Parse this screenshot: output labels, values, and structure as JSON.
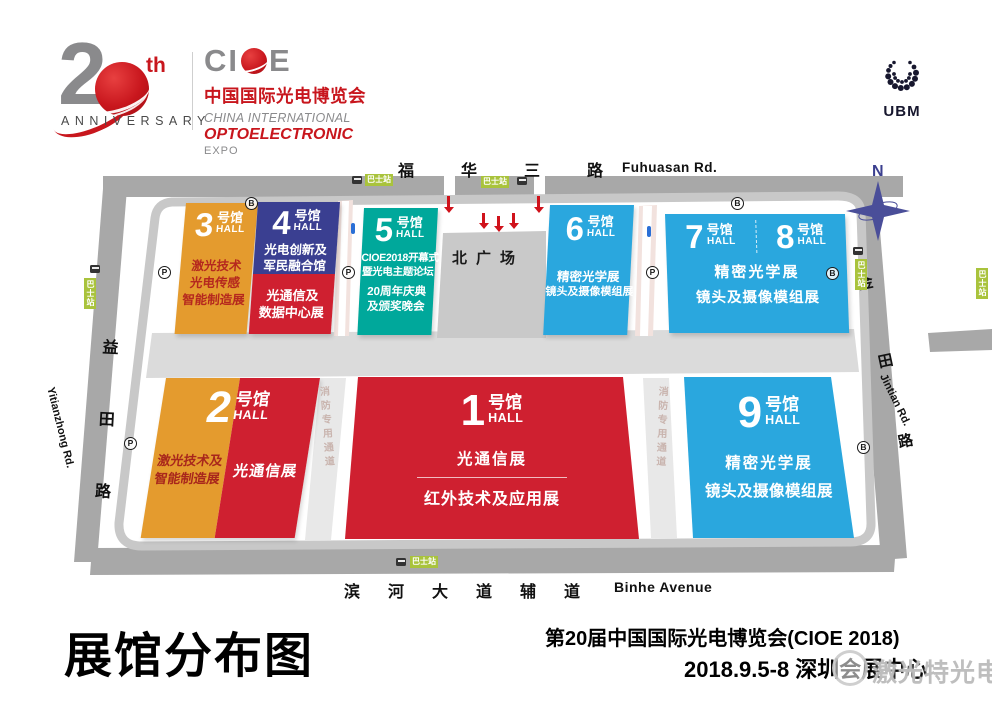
{
  "colors": {
    "brand_red": "#C8161D",
    "logo_gray": "#8A8A8C",
    "hall_orange": "#E49B2E",
    "hall_red": "#CF2030",
    "hall_deep_blue": "#3A3F91",
    "hall_teal": "#00A89B",
    "hall_sky_blue": "#2AA7DE",
    "hall3_body_text": "#B5281E",
    "road_gray": "#A8A8A8",
    "band_gray": "#DBDBDB",
    "plaza_gray": "#C9C9C9",
    "bus_green": "#A9C33C",
    "compass_navy": "#4A4E99",
    "arrow_red": "#D0121B"
  },
  "header": {
    "anniversary": {
      "big_digit": "2",
      "th": "th",
      "label": "ANNIVERSARY"
    },
    "cioe": {
      "wordmark_left": "CI",
      "wordmark_right": "E",
      "cn": "中国国际光电博览会",
      "en_line1": "CHINA INTERNATIONAL",
      "en_line2": "OPTOELECTRONIC",
      "en_line3": "EXPO"
    },
    "ubm": {
      "label": "UBM"
    }
  },
  "compass": {
    "label": "N"
  },
  "roads": {
    "top": {
      "cn": "福华三路",
      "en": "Fuhuasan Rd."
    },
    "bottom": {
      "cn": "滨河大道辅道",
      "en": "Binhe Avenue"
    },
    "left": {
      "cn": "益田路",
      "en": "Yitianzhong Rd."
    },
    "right": {
      "cn_chars": [
        "金",
        "田",
        "路"
      ],
      "en": "Jintian Rd."
    }
  },
  "map": {
    "plaza_label": "北广场",
    "fire_lane_label": "消防专用通道",
    "bus_stop_label": "巴士站",
    "parking_icon": "P",
    "bus_icon": "B",
    "hall_suffix_cn": "号馆",
    "hall_suffix_en": "HALL",
    "halls": {
      "h1": {
        "num": "1",
        "line1": "光通信展",
        "line2": "红外技术及应用展"
      },
      "h2": {
        "num": "2",
        "left_line1": "激光技术及",
        "left_line2": "智能制造展",
        "right_line1": "光通信展"
      },
      "h3": {
        "num": "3",
        "line1": "激光技术",
        "line2": "光电传感",
        "line3": "智能制造展"
      },
      "h4": {
        "num": "4",
        "top_line1": "光电创新及",
        "top_line2": "军民融合馆",
        "bot_line1": "光通信及",
        "bot_line2": "数据中心展"
      },
      "h5": {
        "num": "5",
        "line1": "CIOE2018开幕式",
        "line2": "暨光电主题论坛",
        "line3": "20周年庆典",
        "line4": "及颁奖晚会"
      },
      "h6": {
        "num": "6",
        "line1": "精密光学展",
        "line2": "镜头及摄像模组展"
      },
      "h7": {
        "num": "7"
      },
      "h8": {
        "num": "8",
        "line1": "精密光学展",
        "line2": "镜头及摄像模组展"
      },
      "h9": {
        "num": "9",
        "line1": "精密光学展",
        "line2": "镜头及摄像模组展"
      }
    }
  },
  "footer": {
    "title": "展馆分布图",
    "event_name": "第20届中国国际光电博览会(CIOE 2018)",
    "date_line": "2018.9.5-8 深圳会展中心",
    "watermark": "激光特光电"
  }
}
